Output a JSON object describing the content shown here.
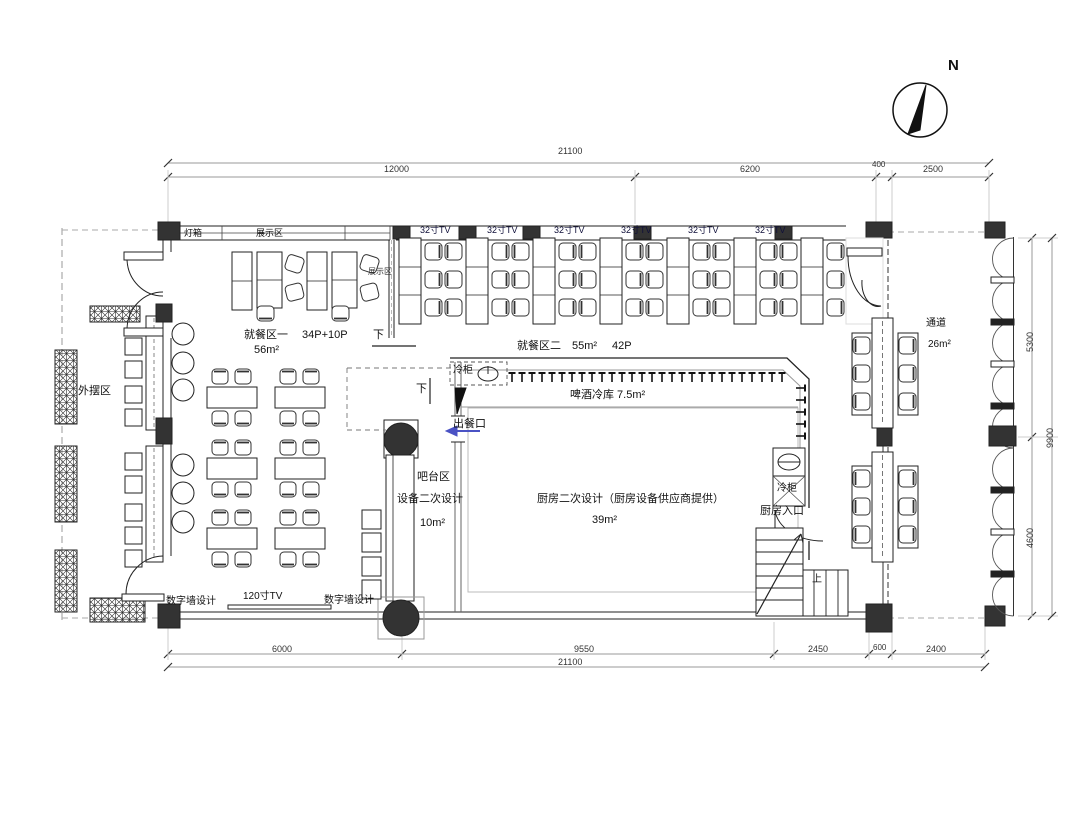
{
  "compass": {
    "north_label": "N"
  },
  "dimensions": {
    "top": {
      "total": "21100",
      "segments": [
        "12000",
        "6200",
        "400",
        "2500"
      ]
    },
    "bottom": {
      "total": "21100",
      "segments": [
        "6000",
        "9550",
        "2450",
        "600",
        "2400"
      ]
    },
    "right": {
      "total": "9900",
      "segments": [
        "5300",
        "4600"
      ]
    }
  },
  "wall_labels": {
    "light_box": "灯箱",
    "display_area": "展示区",
    "display_area_2": "展示区",
    "tv_32": "32寸TV",
    "tv_120": "120寸TV",
    "digital_wall": "数字墙设计"
  },
  "areas": {
    "outdoor": {
      "name": "外摆区"
    },
    "dining_1": {
      "name": "就餐区一",
      "capacity": "34P+10P",
      "area": "56m²"
    },
    "dining_2": {
      "name": "就餐区二",
      "area": "55m²",
      "capacity": "42P"
    },
    "bar": {
      "name": "吧台区",
      "note": "设备二次设计",
      "area": "10m²"
    },
    "beer_cold_room": {
      "name": "啤酒冷库 7.5m²"
    },
    "kitchen": {
      "name": "厨房二次设计（厨房设备供应商提供）",
      "area": "39m²"
    },
    "kitchen_entrance": {
      "name": "厨房入口"
    },
    "corridor": {
      "name": "通道",
      "area": "26m²"
    },
    "serving_window": {
      "name": "出餐口"
    }
  },
  "fixtures": {
    "cold_cabinet": "冷柜",
    "down": "下",
    "up": "上"
  }
}
